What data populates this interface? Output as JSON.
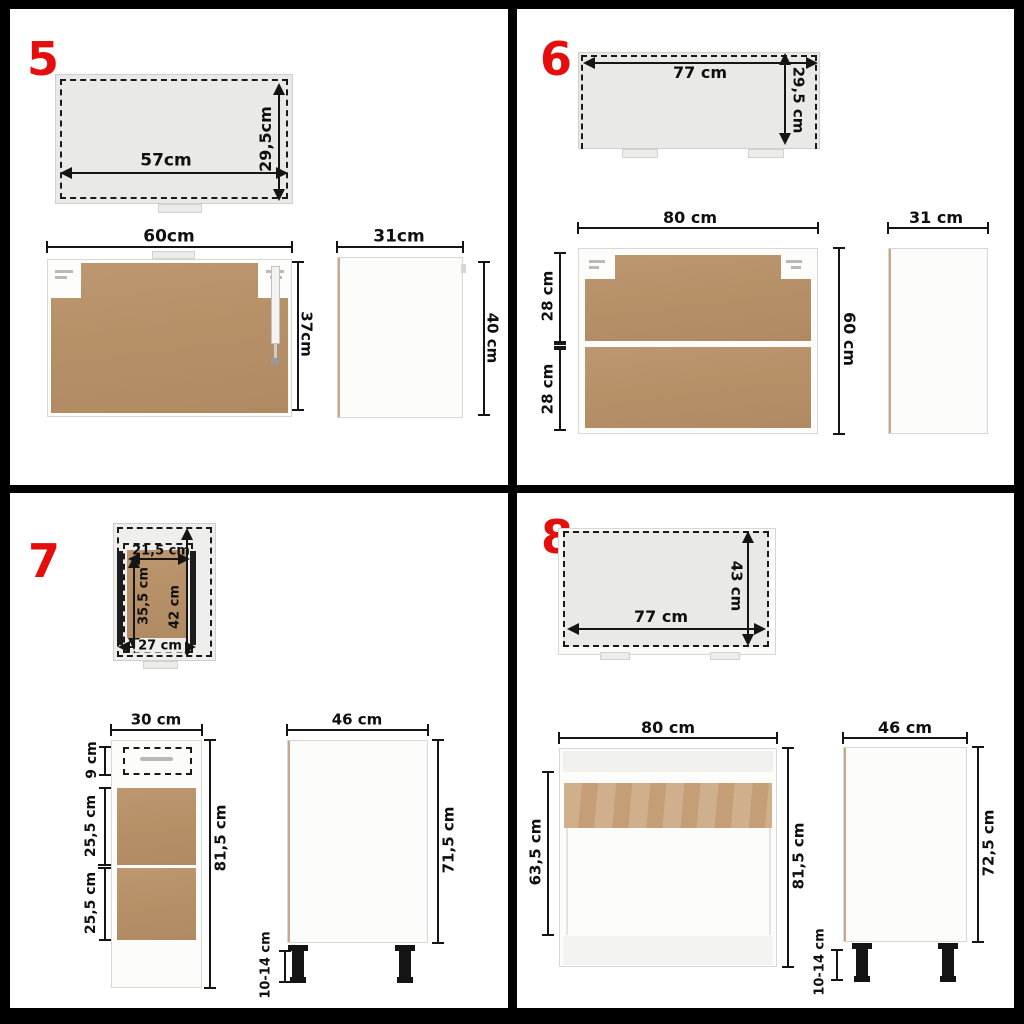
{
  "sheet": {
    "description": "Kitchen cabinet dimension diagrams, panels 5-8"
  },
  "colors": {
    "accent_red": "#e60d0d",
    "wood": "#b8926d",
    "wood_light": "#c9a47c",
    "panel_gray": "#e9e9e7",
    "frame_black": "#000000"
  },
  "q5": {
    "number": "5",
    "top_view": {
      "width_label": "57cm",
      "depth_label": "29,5cm"
    },
    "front_view": {
      "width_label": "60cm",
      "height_label": "37cm"
    },
    "side_view": {
      "width_label": "31cm",
      "height_label": "40 cm"
    }
  },
  "q6": {
    "number": "6",
    "door_view": {
      "width_label": "77 cm",
      "height_label": "29,5 cm"
    },
    "front_view": {
      "width_label": "80 cm",
      "height_label": "60 cm",
      "upper_label": "28 cm",
      "lower_label": "28 cm"
    },
    "side_view": {
      "width_label": "31 cm"
    }
  },
  "q7": {
    "number": "7",
    "drawer_view": {
      "inner_width_label": "21,5 cm",
      "inner_depth_label": "35,5 cm",
      "outer_depth_label": "42 cm",
      "outer_width_label": "27 cm"
    },
    "front_view": {
      "width_label": "30 cm",
      "drawer_label": "9 cm",
      "upper_label": "25,5 cm",
      "lower_label": "25,5 cm",
      "height_label": "81,5 cm"
    },
    "side_view": {
      "depth_label": "46 cm",
      "height_label": "71,5 cm",
      "leg_label": "10-14 cm"
    }
  },
  "q8": {
    "number": "8",
    "door_view": {
      "width_label": "77 cm",
      "height_label": "43 cm"
    },
    "front_view": {
      "width_label": "80 cm",
      "opening_label": "63,5 cm",
      "height_label": "81,5 cm"
    },
    "side_view": {
      "depth_label": "46 cm",
      "height_label": "72,5 cm",
      "leg_label": "10-14 cm"
    }
  }
}
